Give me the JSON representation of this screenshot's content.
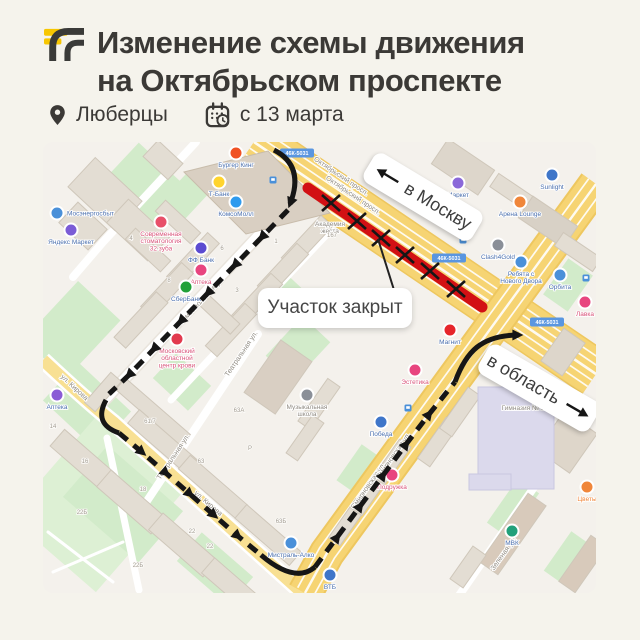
{
  "page": {
    "bg": "#f5f3ec"
  },
  "header": {
    "title_line1": "Изменение схемы движения",
    "title_line2": "на Октябрьском проспекте",
    "location": "Люберцы",
    "date": "с 13 марта",
    "logo_yellow": "#f7c600",
    "logo_dark": "#3a3a38"
  },
  "map": {
    "to_moscow_label": "в Москву",
    "to_region_label": "в область",
    "closed_label": "Участок закрыт",
    "road_badge": "46К-5031",
    "colors": {
      "closed_red": "#d21014",
      "route_black": "#161616",
      "road_yellow": "#f6d473",
      "badge_blue": "#5a96e0"
    },
    "closure": {
      "from": [
        265,
        46
      ],
      "to": [
        439,
        165
      ],
      "x_marks": [
        [
          288,
          61
        ],
        [
          314,
          79
        ],
        [
          338,
          96
        ],
        [
          362,
          113
        ],
        [
          387,
          129
        ],
        [
          413,
          147
        ]
      ]
    },
    "street_labels": [
      {
        "text": "Октябрьский просп.",
        "x": 297,
        "y": 36,
        "rot": 34
      },
      {
        "text": "Октябрьский просп.",
        "x": 309,
        "y": 55,
        "rot": 34
      },
      {
        "text": "Комсомольская ул.",
        "x": 160,
        "y": 160,
        "rot": -47
      },
      {
        "text": "ул. Кирова",
        "x": 30,
        "y": 247,
        "rot": 43
      },
      {
        "text": "ул. Кирова",
        "x": 164,
        "y": 363,
        "rot": 41
      },
      {
        "text": "Театральная ул.",
        "x": 200,
        "y": 213,
        "rot": -56
      },
      {
        "text": "Театральная ул.",
        "x": 132,
        "y": 316,
        "rot": -56
      },
      {
        "text": "Смирновская ул.",
        "x": 327,
        "y": 345,
        "rot": -55
      },
      {
        "text": "Смирновская ул.",
        "x": 352,
        "y": 315,
        "rot": -55
      },
      {
        "text": "Зеленая ул.",
        "x": 462,
        "y": 413,
        "rot": -55
      }
    ],
    "badges": [
      {
        "x": 254,
        "y": 11
      },
      {
        "x": 406,
        "y": 116
      },
      {
        "x": 504,
        "y": 180
      }
    ],
    "pois": [
      {
        "label": "Бургер Кинг",
        "x": 193,
        "y": 11,
        "dot": "#f05123",
        "lc": "#4a6fae"
      },
      {
        "label": "Т-Банк",
        "x": 176,
        "y": 40,
        "dot": "#ffd42e",
        "lc": "#4a6fae"
      },
      {
        "label": "КомсоМолл",
        "x": 193,
        "y": 60,
        "dot": "#2f9bee",
        "lc": "#4a6fae"
      },
      {
        "label": "Мосэнергосбыт",
        "x": 14,
        "y": 71,
        "dot": "#4a90d9",
        "lc": "#4a6fae",
        "align": "right"
      },
      {
        "label": "Яндекс Маркет",
        "x": 28,
        "y": 88,
        "dot": "#7b5cd6",
        "lc": "#4a6fae"
      },
      {
        "label": "Современная стоматология 32 зуба",
        "x": 118,
        "y": 80,
        "dot": "#e8506a",
        "lc": "#d9537a"
      },
      {
        "label": "ФФ Банк",
        "x": 158,
        "y": 106,
        "dot": "#5b4bd1",
        "lc": "#4a6fae"
      },
      {
        "label": "Аптека",
        "x": 158,
        "y": 128,
        "dot": "#e8457f",
        "lc": "#d9537a"
      },
      {
        "label": "СберБанк",
        "x": 143,
        "y": 145,
        "dot": "#21a038",
        "lc": "#4a6fae"
      },
      {
        "label": "Московский областной центр крови",
        "x": 134,
        "y": 197,
        "dot": "#e23a4e",
        "lc": "#d9537a"
      },
      {
        "label": "Академия жеста",
        "x": 287,
        "y": 84,
        "dot": "none",
        "lc": "#8f8a82"
      },
      {
        "label": "Маркет",
        "x": 415,
        "y": 41,
        "dot": "#8a68d9",
        "lc": "#4a6fae"
      },
      {
        "label": "Sunlight",
        "x": 509,
        "y": 33,
        "dot": "#3f76c9",
        "lc": "#4a6fae"
      },
      {
        "label": "Арена Lounge",
        "x": 477,
        "y": 60,
        "dot": "#f0863a",
        "lc": "#4a6fae"
      },
      {
        "label": "Clash4Gold",
        "x": 455,
        "y": 103,
        "dot": "#8a8f98",
        "lc": "#4a6fae"
      },
      {
        "label": "Ребята с Нового Двора",
        "x": 478,
        "y": 120,
        "dot": "#4a90d9",
        "lc": "#4a6fae"
      },
      {
        "label": "Орбита",
        "x": 517,
        "y": 133,
        "dot": "#4a90d9",
        "lc": "#4a6fae"
      },
      {
        "label": "Лавка",
        "x": 542,
        "y": 160,
        "dot": "#e8457f",
        "lc": "#d9537a"
      },
      {
        "label": "Магнит",
        "x": 407,
        "y": 188,
        "dot": "#e6252b",
        "lc": "#4a6fae"
      },
      {
        "label": "Эстетика",
        "x": 372,
        "y": 228,
        "dot": "#e8457f",
        "lc": "#d9537a"
      },
      {
        "label": "Победа",
        "x": 338,
        "y": 280,
        "dot": "#3f76c9",
        "lc": "#4a6fae"
      },
      {
        "label": "Подружка",
        "x": 349,
        "y": 333,
        "dot": "#e8457f",
        "lc": "#d9537a"
      },
      {
        "label": "Мистраль-Алко",
        "x": 248,
        "y": 401,
        "dot": "#4a90d9",
        "lc": "#4a6fae"
      },
      {
        "label": "Музыкальная школа",
        "x": 264,
        "y": 253,
        "dot": "#8a8f98",
        "lc": "#8f8a82"
      },
      {
        "label": "Аптека",
        "x": 14,
        "y": 253,
        "dot": "#8a5cd6",
        "lc": "#4a6fae"
      },
      {
        "label": "МВК",
        "x": 469,
        "y": 389,
        "dot": "#21a07a",
        "lc": "#4a6fae"
      },
      {
        "label": "ВТБ",
        "x": 287,
        "y": 433,
        "dot": "#3f76c9",
        "lc": "#4a6fae"
      },
      {
        "label": "Цветы",
        "x": 544,
        "y": 345,
        "dot": "#f0863a",
        "lc": "#f0863a"
      },
      {
        "label": "Гимназия № 1",
        "x": 480,
        "y": 268,
        "dot": "none",
        "lc": "#8f8a82"
      }
    ],
    "building_numbers": [
      {
        "t": "14",
        "x": 10,
        "y": 286
      },
      {
        "t": "16",
        "x": 42,
        "y": 321
      },
      {
        "t": "18",
        "x": 100,
        "y": 349
      },
      {
        "t": "22Б",
        "x": 39,
        "y": 372
      },
      {
        "t": "22Б",
        "x": 95,
        "y": 425
      },
      {
        "t": "22",
        "x": 149,
        "y": 391
      },
      {
        "t": "22",
        "x": 167,
        "y": 406
      },
      {
        "t": "61/7",
        "x": 107,
        "y": 281
      },
      {
        "t": "63",
        "x": 158,
        "y": 321
      },
      {
        "t": "63А",
        "x": 196,
        "y": 270
      },
      {
        "t": "63Б",
        "x": 238,
        "y": 381
      },
      {
        "t": "Р",
        "x": 207,
        "y": 308
      },
      {
        "t": "4",
        "x": 88,
        "y": 98
      },
      {
        "t": "8",
        "x": 126,
        "y": 140
      },
      {
        "t": "6",
        "x": 179,
        "y": 108
      },
      {
        "t": "3",
        "x": 194,
        "y": 150
      },
      {
        "t": "1",
        "x": 233,
        "y": 101
      },
      {
        "t": "167",
        "x": 289,
        "y": 95
      }
    ],
    "bus_stops": [
      [
        230,
        38
      ],
      [
        420,
        98
      ],
      [
        543,
        136
      ],
      [
        365,
        266
      ]
    ]
  }
}
